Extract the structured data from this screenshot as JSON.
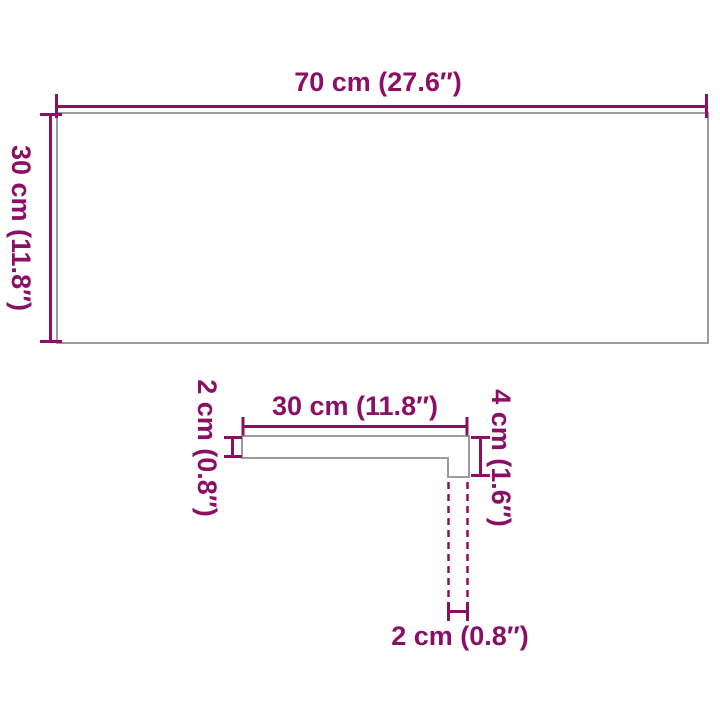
{
  "diagram": {
    "title": "product-dimension-diagram",
    "top_view": {
      "width_label": "70 cm (27.6″)",
      "height_label": "30 cm (11.8″)"
    },
    "profile_view": {
      "depth_label": "30 cm (11.8″)",
      "thickness_label": "2 cm (0.8″)",
      "nose_height_label": "4 cm (1.6″)",
      "nose_depth_label": "2 cm (0.8″)"
    },
    "colors": {
      "dimension_color": "#8a1065",
      "outline_color": "#9b9b9b",
      "background": "#ffffff"
    }
  }
}
